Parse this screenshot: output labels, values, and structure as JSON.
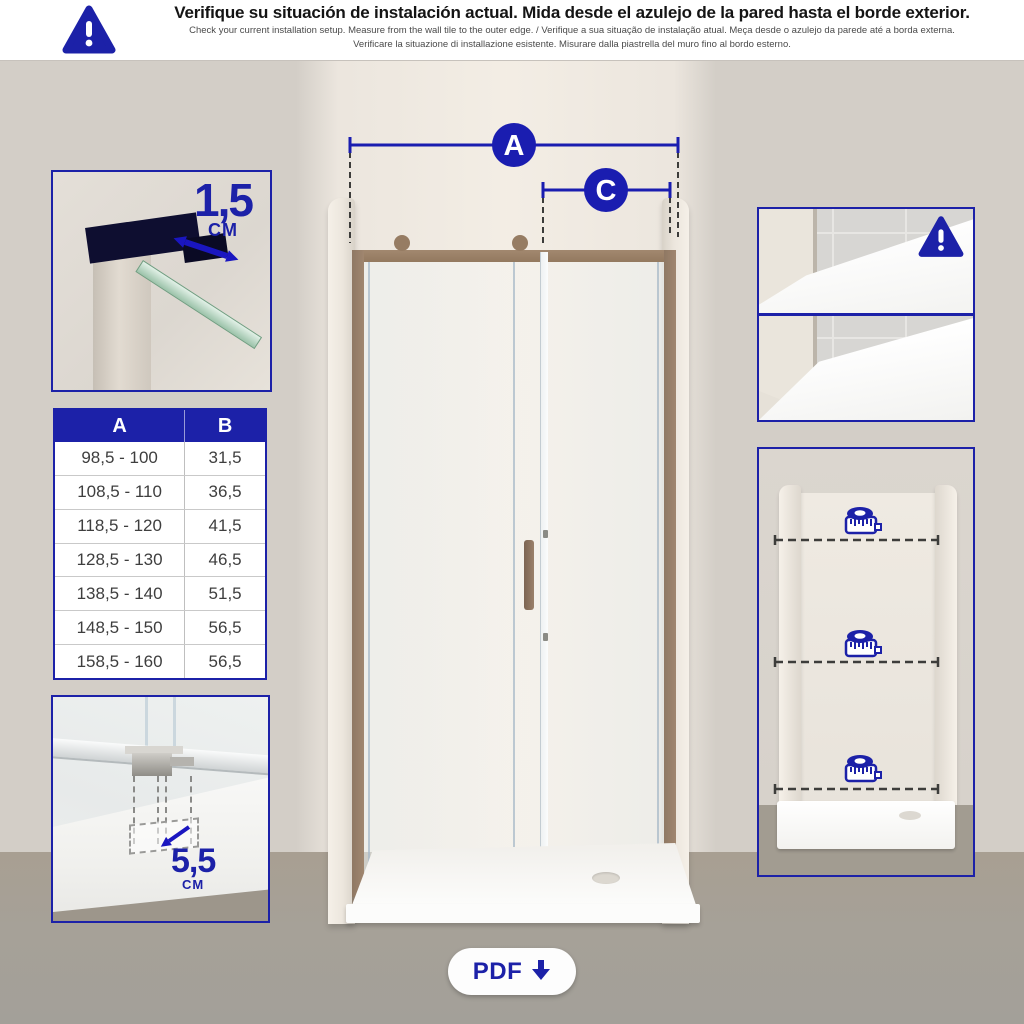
{
  "colors": {
    "accent": "#1c21a8",
    "arrow_blue": "#1a16c0",
    "bronze_frame": "#9a8169",
    "wall_beige": "#d3cec7",
    "floor_gray": "#a49e94",
    "table_header_bg": "#1c21a8"
  },
  "header": {
    "warning_icon_glyph": "!",
    "title": "Verifique su situación de instalación actual. Mida desde el azulejo de la pared hasta el borde exterior.",
    "subtitle_line1": "Check your current installation setup. Measure from the wall tile to the outer edge. / Verifique a sua situação de instalação atual. Meça desde o azulejo da parede até a borda externa.",
    "subtitle_line2": "Verificare la situazione di installazione esistente. Misurare dalla piastrella del muro fino al bordo esterno."
  },
  "measurements": {
    "overall_width_label": "A",
    "door_width_label": "C",
    "top_adjustment": {
      "value": "1,5",
      "unit": "CM"
    },
    "bottom_clearance": {
      "value": "5,5",
      "unit": "CM"
    }
  },
  "dimension_table": {
    "columns": [
      "A",
      "B"
    ],
    "rows": [
      [
        "98,5 - 100",
        "31,5"
      ],
      [
        "108,5 - 110",
        "36,5"
      ],
      [
        "118,5 - 120",
        "41,5"
      ],
      [
        "128,5 - 130",
        "46,5"
      ],
      [
        "138,5 - 140",
        "51,5"
      ],
      [
        "148,5 - 150",
        "56,5"
      ],
      [
        "158,5 - 160",
        "56,5"
      ]
    ]
  },
  "right_panels": {
    "warning_icon_glyph": "!",
    "tape_icon_count": 3
  },
  "pdf_button": {
    "label": "PDF",
    "icon": "download-arrow"
  }
}
